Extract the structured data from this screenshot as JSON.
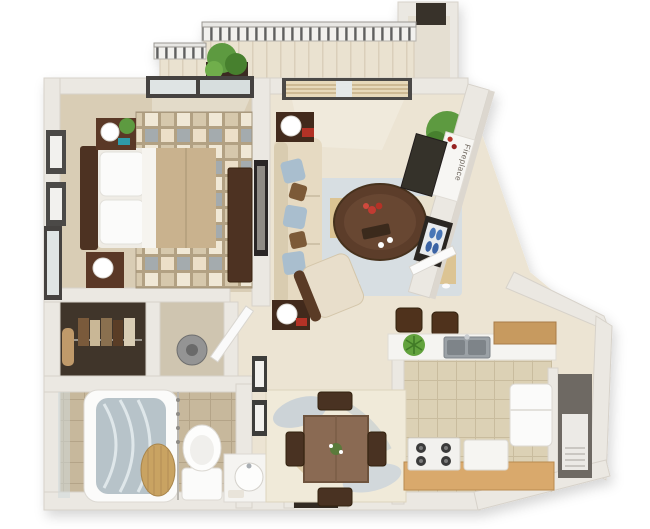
{
  "scene": {
    "kind": "3d-floor-plan-rendering",
    "depicts": "one-bedroom apartment with balcony"
  },
  "labels": {
    "fireplace": "Fireplace"
  },
  "colors": {
    "background": "#ffffff",
    "wall": "#ebe8e2",
    "wall_edge": "#d7d2ca",
    "main_floor": "#ece4d3",
    "bedroom_carpet": "#d9cdb5",
    "bath_tile": "#c7b89c",
    "kitchen_tile": "#dcd1b5",
    "balcony_floor": "#eae2d0",
    "wood_dark": "#4e3120",
    "wood_medium": "#8a6a52",
    "wood_counter": "#d9a96c",
    "cabinet_wood": "#c79a5e",
    "sofa": "#e6dac2",
    "bed_blanket": "#c9b28e",
    "pillow_blue": "#a9bece",
    "pillow_brown": "#7b5a38",
    "rug_blue": "#d7dee2",
    "rug_tan": "#dcc493",
    "dining_rug": "#f0ead9",
    "rug_motif_gray": "#c6cfd6",
    "bedroom_rug_base": "#b2a183",
    "plant_green": "#5d9a3f",
    "accent_red": "#b33028",
    "shoe_blue": "#4a76b6",
    "appliance_white": "#f6f5f2",
    "stainless": "#9ba1a6",
    "fireplace_dark": "#34302b",
    "closet_dark": "#332b22",
    "glass": "#dfe4e4",
    "water_glass": "#b7c3c9",
    "door_frame": "#45433f",
    "hamper_tan": "#c9a362"
  },
  "rooms": [
    {
      "id": "balcony",
      "items": [
        "railing",
        "potted-plant",
        "balcony-storage-closet",
        "plank-floor"
      ]
    },
    {
      "id": "bedroom",
      "items": [
        "bed",
        "headboard",
        "pillows",
        "nightstand-with-lamp",
        "second-nightstand-with-lamp",
        "dresser",
        "checkered-area-rug",
        "wall-art-frames",
        "window",
        "sliding-glass-door"
      ]
    },
    {
      "id": "living-room",
      "items": [
        "sofa",
        "throw-pillows",
        "end-table-with-lamp",
        "second-end-table-with-lamp",
        "oval-coffee-table",
        "flower-centerpiece",
        "blue-area-rug",
        "lounge-chair",
        "corner-potted-plant",
        "sliding-glass-door-with-blinds",
        "wall-art",
        "fireplace-with-mantel-candles"
      ]
    },
    {
      "id": "entry",
      "items": [
        "open-front-door",
        "shoe-cubby-with-blue-shoes",
        "threshold"
      ]
    },
    {
      "id": "hallway-closets",
      "items": [
        "walk-in-closet",
        "hanging-clothes",
        "towel",
        "utility-closet",
        "vacuum-canister",
        "hall-door-ajar"
      ]
    },
    {
      "id": "bathroom",
      "items": [
        "bathtub",
        "shower-glass",
        "bunched-shower-curtain",
        "toilet",
        "vanity-sink",
        "towels",
        "storage-niche-with-drawers"
      ]
    },
    {
      "id": "dining-area",
      "items": [
        "square-dining-table",
        "four-chairs",
        "patterned-area-rug",
        "wall-art-frames",
        "table-centerpiece"
      ]
    },
    {
      "id": "kitchen",
      "items": [
        "breakfast-bar",
        "two-bar-stools",
        "bar-plant",
        "double-stainless-sink",
        "overhead-wood-cabinet",
        "refrigerator",
        "range-with-burners",
        "dishwasher",
        "wood-counter",
        "utility-closet-with-water-heater"
      ]
    }
  ]
}
